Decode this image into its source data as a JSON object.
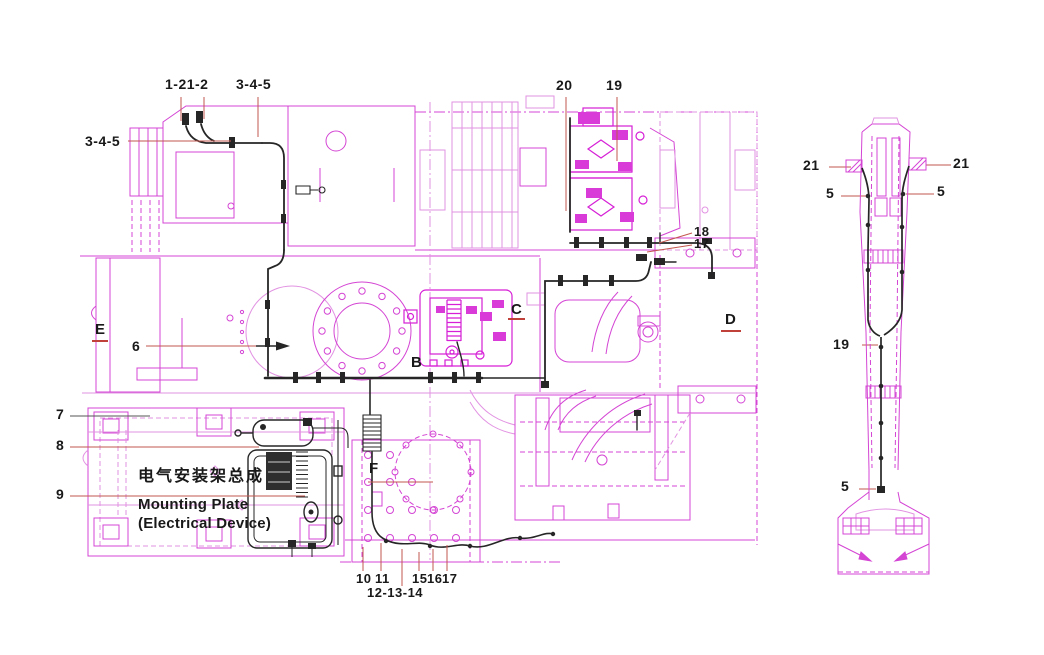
{
  "diagram": {
    "kind": "electrical mounting plate assembly drawing",
    "views": [
      "main chassis plan view",
      "boom side view"
    ]
  },
  "colors": {
    "cad_magenta": "#d445d4",
    "cad_magenta_dense": "#d61fd6",
    "harness_black": "#262626",
    "leader_red": "#c2564e",
    "underline_red": "#c0403a",
    "text": "#191919",
    "background": "#ffffff"
  },
  "captions": {
    "assembly_zh": "电气安装架总成",
    "assembly_en1": "Mounting Plate",
    "assembly_en2": "(Electrical Device)"
  },
  "callouts_main": {
    "top_group_a": "1-21-2",
    "top_group_b": "3-4-5",
    "left_group": "3-4-5",
    "n20": "20",
    "n19": "19",
    "n18": "18",
    "n17": "17",
    "n6": "6",
    "n7": "7",
    "n8": "8",
    "n9": "9",
    "n10": "10",
    "n11": "11",
    "n12_14": "12-13-14",
    "n15": "15",
    "n16": "16",
    "n17b": "17",
    "letter_e": "E",
    "letter_b": "B",
    "letter_c": "C",
    "letter_d": "D",
    "letter_f": "F"
  },
  "callouts_side": {
    "n21_left": "21",
    "n21_right": "21",
    "n5_left": "5",
    "n5_right": "5",
    "n19": "19",
    "n5_bottom": "5"
  }
}
